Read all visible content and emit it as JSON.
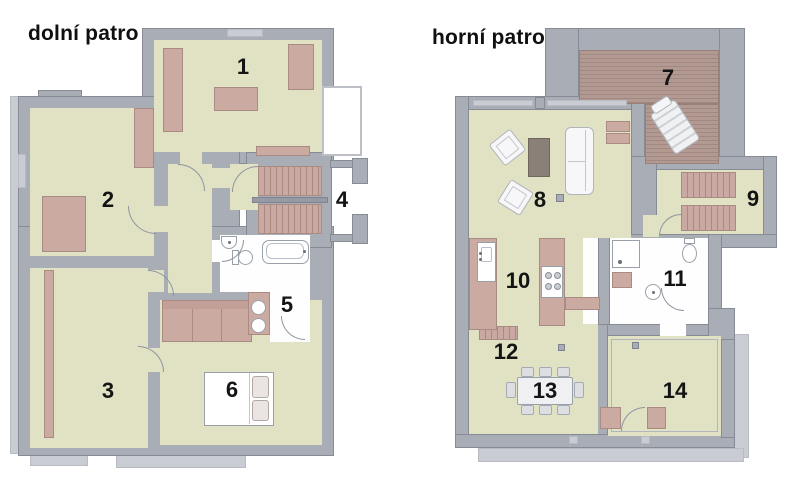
{
  "colors": {
    "wall": "#a9adb6",
    "wall_border": "#868b95",
    "wall_light": "#c9ccd3",
    "floor": "#e1e2c3",
    "furn": "#cbaaa2",
    "furn_border": "#a98b83",
    "deck": "#b29a92",
    "deck_stripe": "#a18881",
    "step": "#c9a9a1",
    "step_stripe": "#aa8981",
    "dark_table": "#8a8078",
    "fixture_border": "#9aa0a8",
    "label": "#141414"
  },
  "plans": [
    {
      "title": "dolní patro",
      "rooms": [
        {
          "number": "1"
        },
        {
          "number": "2"
        },
        {
          "number": "3"
        },
        {
          "number": "4"
        },
        {
          "number": "5"
        },
        {
          "number": "6"
        }
      ]
    },
    {
      "title": "horní patro",
      "rooms": [
        {
          "number": "7"
        },
        {
          "number": "8"
        },
        {
          "number": "9"
        },
        {
          "number": "10"
        },
        {
          "number": "11"
        },
        {
          "number": "12"
        },
        {
          "number": "13"
        },
        {
          "number": "14"
        }
      ]
    }
  ]
}
